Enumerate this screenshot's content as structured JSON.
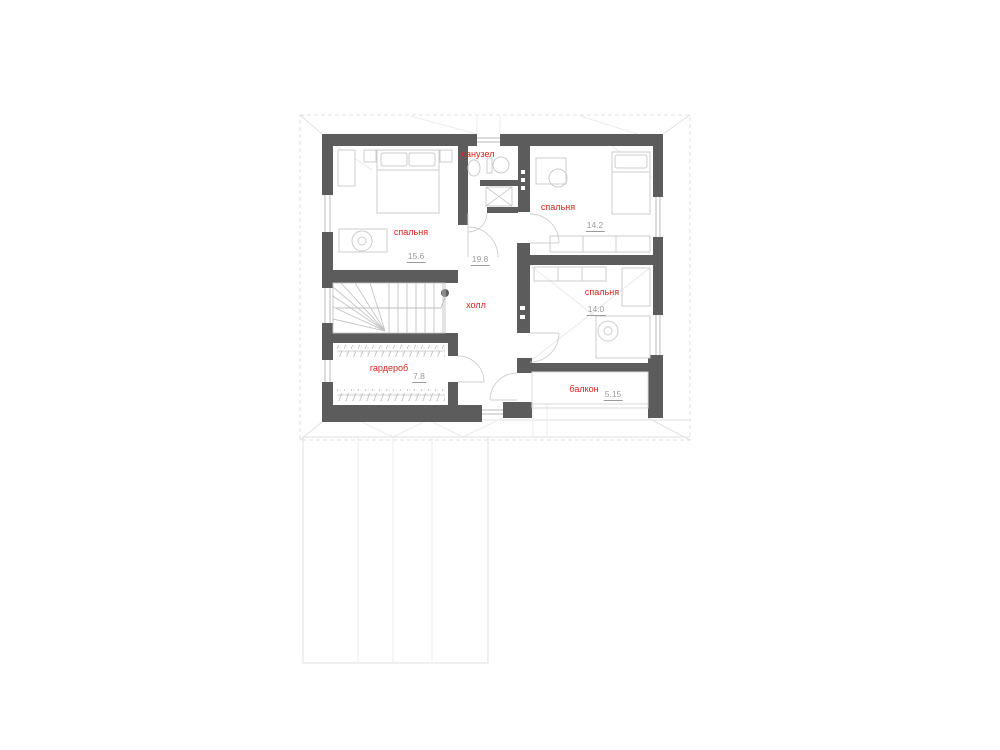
{
  "plan": {
    "floor_name": "second-floor-plan",
    "rooms": {
      "bathroom": {
        "label": "санузел",
        "area": ""
      },
      "bedroom_left": {
        "label": "спальня",
        "area": "15.6"
      },
      "bedroom_top_right": {
        "label": "спальня",
        "area": "14.2"
      },
      "bedroom_mid_right": {
        "label": "спальня",
        "area": "14.0"
      },
      "hall": {
        "label": "холл",
        "area": "19.8"
      },
      "wardrobe": {
        "label": "гардероб",
        "area": "7.8"
      },
      "balcony": {
        "label": "балкон",
        "area": "5.15"
      }
    },
    "colors": {
      "wall": "#5c5c5c",
      "room_label": "#d8241c",
      "area_label": "#9a9a9a",
      "furniture": "#cccccc",
      "roof_outline": "#e2e2e2",
      "window": "#b8b8b8"
    }
  }
}
